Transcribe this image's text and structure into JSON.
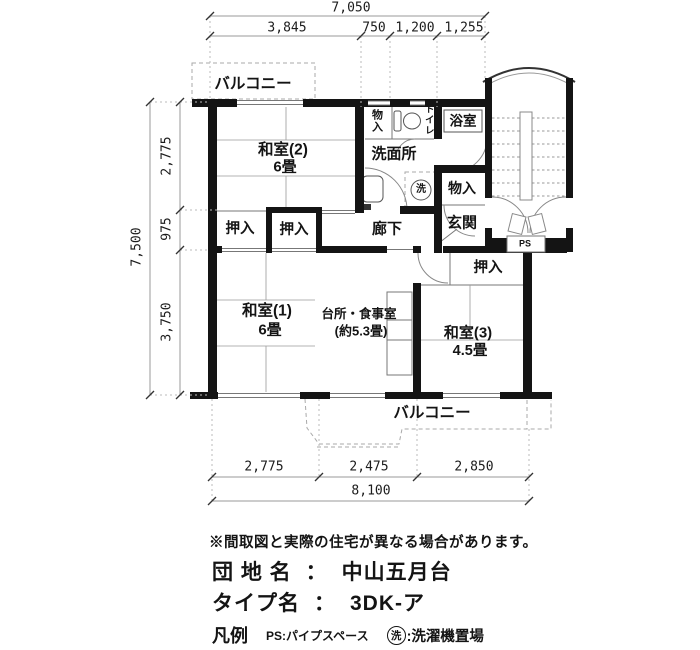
{
  "plan": {
    "balcony_top": "バルコニー",
    "balcony_bottom": "バルコニー",
    "washitsu2": "和室(2)",
    "washitsu2_size": "6畳",
    "monoire_top": "物入",
    "toilet": "トイレ",
    "bath": "浴室",
    "senmenjo": "洗面所",
    "wash_symbol": "洗",
    "monoire_mid": "物入",
    "oshiire_1": "押入",
    "oshiire_2": "押入",
    "oshiire_3": "押入",
    "rouka": "廊下",
    "genkan": "玄関",
    "ps": "PS",
    "washitsu1": "和室(1)",
    "washitsu1_size": "6畳",
    "dk": "台所・食事室",
    "dk_size": "(約5.3畳)",
    "washitsu3": "和室(3)",
    "washitsu3_size": "4.5畳"
  },
  "dims": {
    "top_total": "7,050",
    "top": [
      "3,845",
      "750",
      "1,200",
      "1,255"
    ],
    "left_total": "7,500",
    "left": [
      "2,775",
      "975",
      "3,750"
    ],
    "bottom": [
      "2,775",
      "2,475",
      "2,850"
    ],
    "bottom_total": "8,100"
  },
  "footer": {
    "note": "※間取図と実際の住宅が異なる場合があります。",
    "estate_label": "団 地 名",
    "estate_sep": "：",
    "estate_value": "中山五月台",
    "type_label": "タイプ名",
    "type_sep": "：",
    "type_value": "3DK-ア",
    "legend_label": "凡例",
    "legend_ps": "PS:パイプスペース",
    "legend_wash_symbol": "洗",
    "legend_wash": ":洗濯機置場"
  },
  "colors": {
    "wall": "#141414",
    "line": "#777777",
    "light": "#b0b0b0",
    "text": "#141414"
  }
}
